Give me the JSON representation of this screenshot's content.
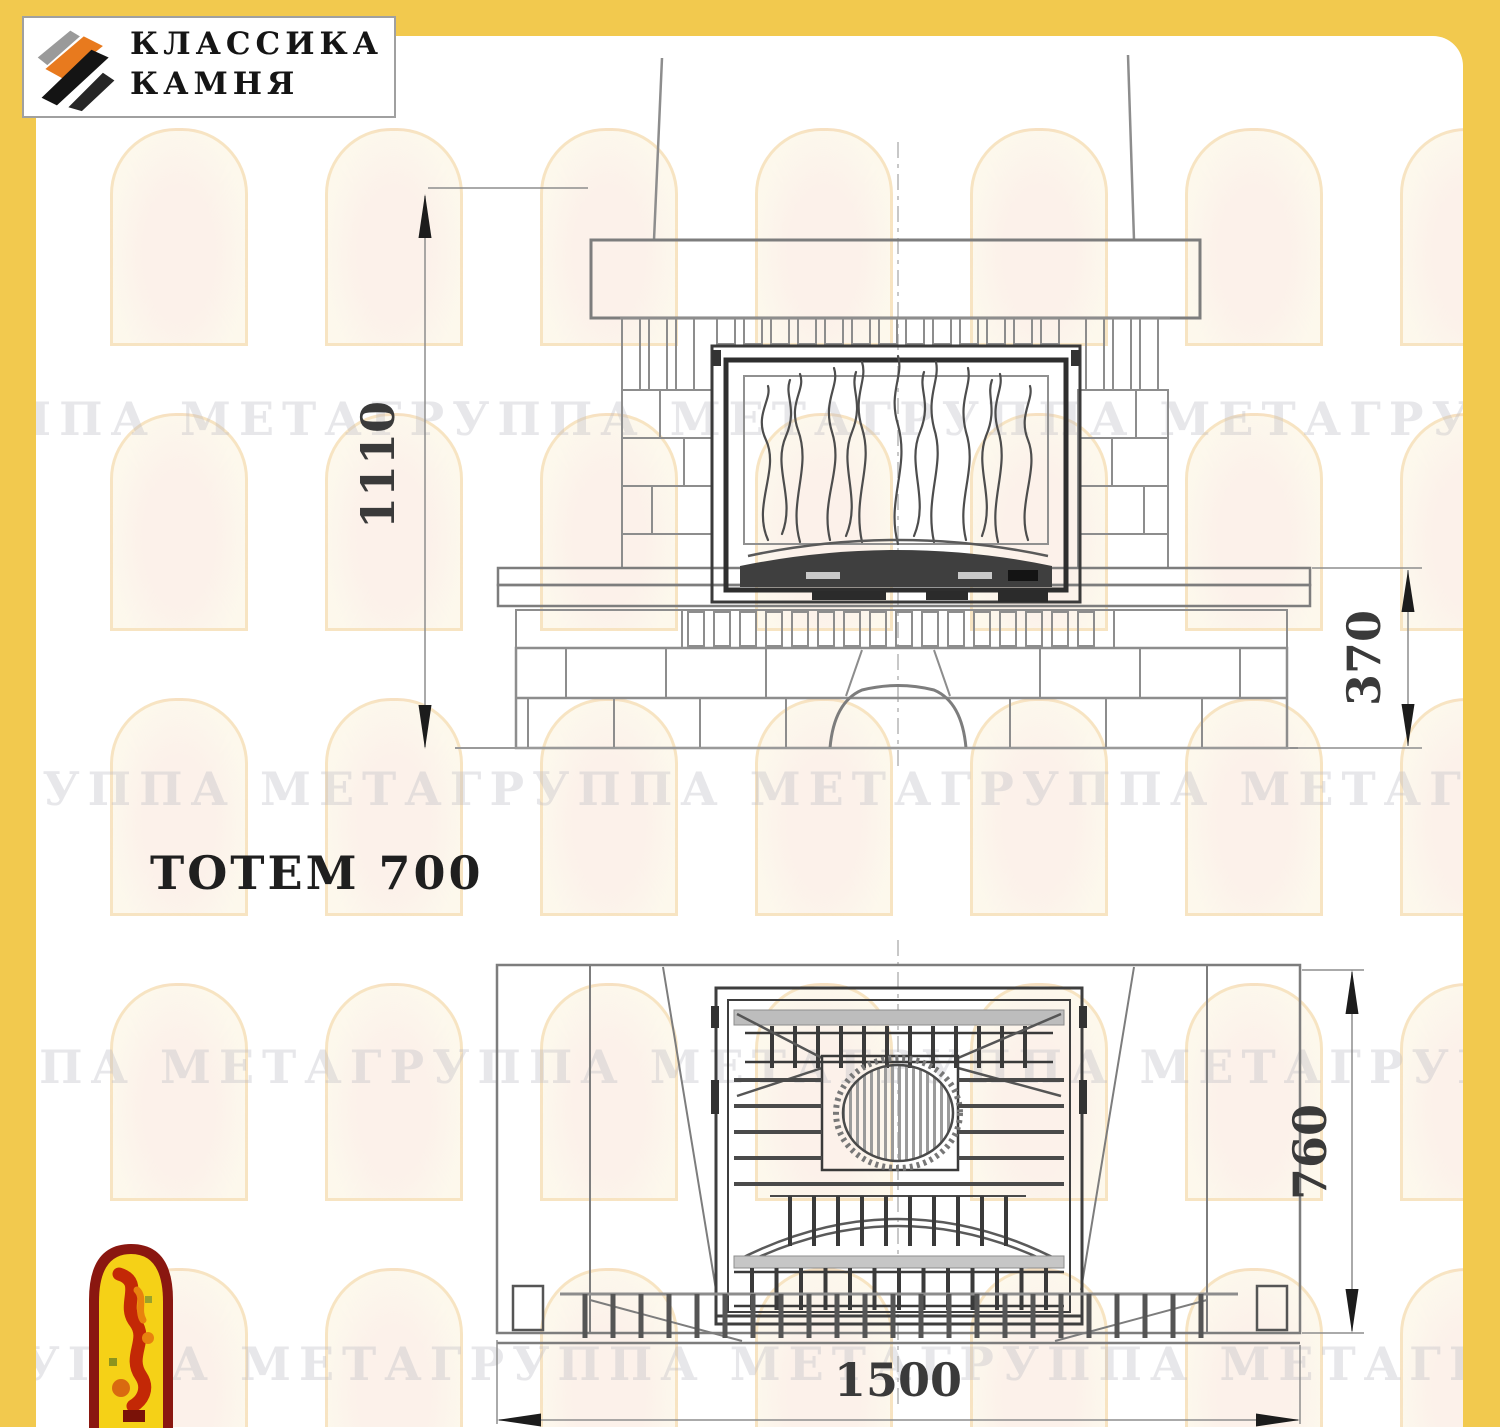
{
  "logo": {
    "line1": "КЛАССИКА",
    "line2": "КАМНЯ",
    "icon": "diagonal-stone-stripes-icon"
  },
  "title": "ТОТЕМ 700",
  "watermark": {
    "text": "ГРУППА МЕТАГРУППА МЕТАГРУППА МЕТАГРУППА МЕТАГРУППА МЕТА",
    "icon": "arch-window-watermark"
  },
  "front_view": {
    "name": "fireplace-front-elevation",
    "dim_height_total": "1110",
    "dim_height_bench": "370"
  },
  "plan_view": {
    "name": "fireplace-top-plan",
    "dim_depth": "760",
    "dim_width": "1500"
  },
  "mascot": {
    "icon": "meta-flame-figure-mascot"
  },
  "colors": {
    "frame_yellow": "#f2c94e",
    "logo_orange": "#e87a1e",
    "mascot_red": "#c32806",
    "mascot_yellow": "#f5d117",
    "line_gray": "#7d7d7d",
    "dark_line": "#3a3a3a"
  }
}
